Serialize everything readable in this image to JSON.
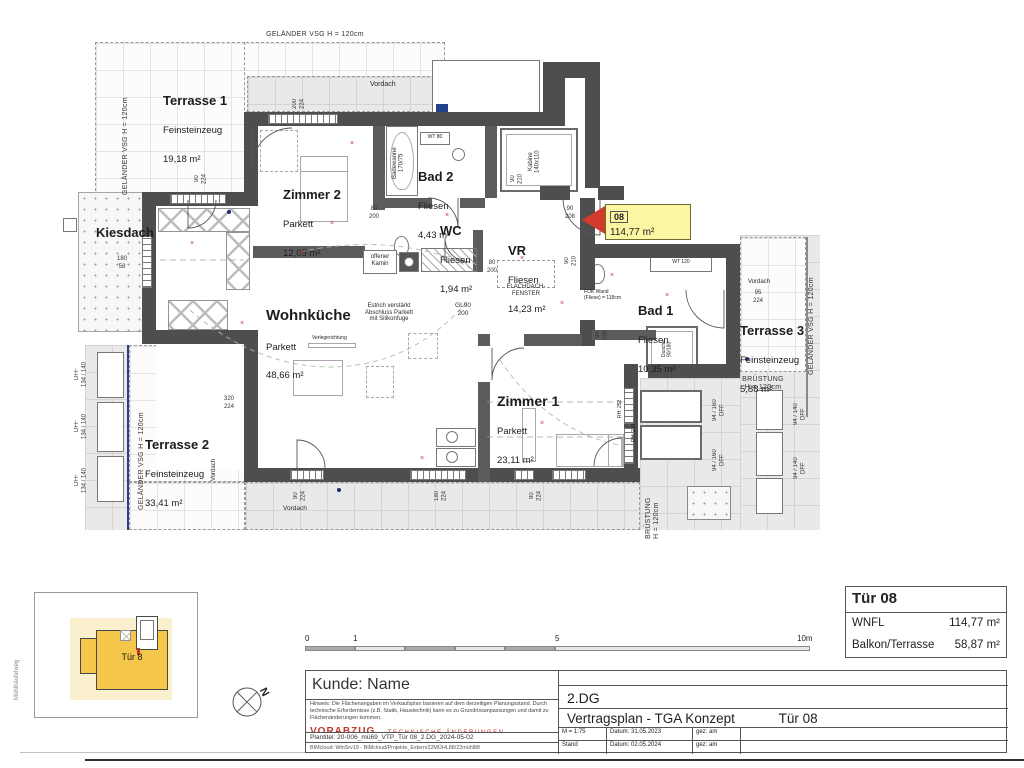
{
  "colors": {
    "wall": "#4e4e4e",
    "tag_bg": "#faf6a3",
    "arrow_red": "#d43a2b",
    "site_yellow": "#f4c64a",
    "vorabzug_red": "#c0392b",
    "railing_blue": "#2c3f8f"
  },
  "labels": {
    "gelaender": "GELÄNDER VSG H = 120cm",
    "bruestung2": "BRÜSTUNG\nH = 120cm",
    "kiesdach": "Kiesdach",
    "vordach": "Vordach"
  },
  "rooms": {
    "terrasse1": {
      "name": "Terrasse 1",
      "finish": "Feinsteinzeug",
      "area": "19,18 m²"
    },
    "terrasse2": {
      "name": "Terrasse 2",
      "finish": "Feinsteinzeug",
      "area": "33,41 m²"
    },
    "terrasse3": {
      "name": "Terrasse 3",
      "finish": "Feinsteinzeug",
      "area": "5,88 m²"
    },
    "zimmer1": {
      "name": "Zimmer 1",
      "finish": "Parkett",
      "area": "23,11 m²"
    },
    "zimmer2": {
      "name": "Zimmer 2",
      "finish": "Parkett",
      "area": "12,05 m²"
    },
    "wohnkueche": {
      "name": "Wohnküche",
      "finish": "Parkett",
      "area": "48,66 m²"
    },
    "bad1": {
      "name": "Bad 1",
      "finish": "Fliesen",
      "area": "10,35 m²"
    },
    "bad2": {
      "name": "Bad 2",
      "finish": "Fliesen",
      "area": "4,43 m²"
    },
    "wc": {
      "name": "WC",
      "finish": "Fliesen",
      "area": "1,94 m²"
    },
    "vr": {
      "name": "VR",
      "finish": "Fliesen",
      "area": "14,23 m²"
    }
  },
  "unit_tag": {
    "number": "08",
    "area": "114,77 m²"
  },
  "annotations": {
    "offener_kamin": "offener\nKamin",
    "estrich": "Estrich verstärkt\nAbschluss Parkett\nmit Silikonfuge",
    "verlegerichtung": "Verlegerichtung",
    "flachdachfenster": "FLACHDACH-\nFENSTER",
    "fok_wand": "FOK Wand\n(Fliese) = 118cm",
    "kabine": "Kabine\n140x110",
    "badewanne": "Badewanne\n170/75",
    "wt80": "WT 80",
    "wt120": "WT 120",
    "dusche": "Dusche\n90/180",
    "rh252": "RH: 252",
    "rh210": "RH: 210"
  },
  "dims": {
    "d_top_window": "200\n224",
    "d_t1_door": "90\n224",
    "d_entry": "90\n208",
    "d_z2_door": "80\n200",
    "d_wc": "80\n200",
    "d_kabine": "90\n210",
    "d_vr_door": "90\n210",
    "d_gl": "GL90\n200",
    "d_t2": "320\n224",
    "d_b1": "90\n224",
    "d_b2": "180\n224",
    "d_b3": "90\n224",
    "d_t3": "95\n224",
    "d_kies": "180\n58",
    "d_bad1_door": "80\n200"
  },
  "dff": {
    "left": "DFF\n134 / 140",
    "right_inner": "94 / 160\nDFF",
    "right_outer": "94 / 140\nDFF"
  },
  "scalebar": {
    "t0": "0",
    "t1": "1",
    "t5": "5",
    "t10": "10m"
  },
  "titleblock": {
    "title": "Tür 08",
    "row1_label": "WNFL",
    "row1_value": "114,77 m²",
    "row2_label": "Balkon/Terrasse",
    "row2_value": "58,87 m²"
  },
  "footer": {
    "kunde": "Kunde: Name",
    "hinweis": "Hinweis: Die Flächenangaben im Verkaufsplan basieren auf dem derzeitigen Planungsstand. Durch technische Erfordernisse (z.B. Statik, Haustechnik) kann es zu  Grundrissanpassungen und damit zu Flächenänderungen kommen.",
    "vorabzug": "VORABZUG",
    "vorbehalt": "TECHNISCHE ÄNDERUNGEN VORBEHALTEN",
    "plantitel": "Plantitel:   20-006_mü69_VTP_Tür 08_2.DG_2024-05-02",
    "bimcloud": "BIMcloud: WinSrv19 - BIMcloud/Projekte_Extern/22MÜHL88/22mühl88",
    "geschoss": "2.DG",
    "plan_name": "Vertragsplan - TGA Konzept",
    "plan_unit": "Tür 08",
    "m": "M = 1:75",
    "datum1": "Datum:  31.05.2023",
    "gez1": "gez:  am",
    "stand": "Stand",
    "datum2": "Datum:  02.05.2024",
    "gez2": "gez:  am"
  },
  "sitemap": {
    "unit": "Tür 8",
    "street": "Mühlhäufelweg"
  },
  "compass": {
    "n": "N"
  }
}
